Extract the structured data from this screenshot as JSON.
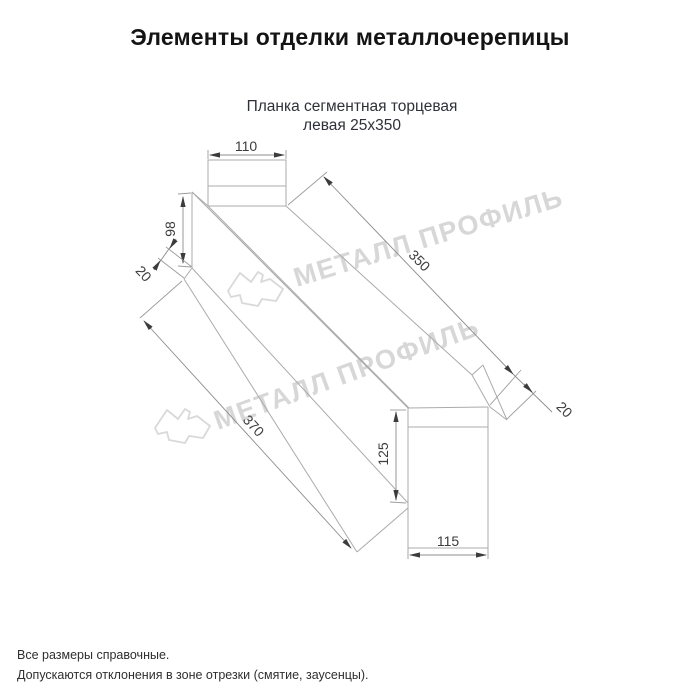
{
  "header": {
    "title": "Элементы отделки металлочерепицы"
  },
  "subtitle": {
    "line1": "Планка сегментная торцевая",
    "line2": "левая 25х350"
  },
  "drawing": {
    "dimensions": {
      "top_width": "110",
      "left_height": "98",
      "left_lip": "20",
      "top_length": "350",
      "right_lip": "20",
      "bottom_length": "370",
      "right_height": "125",
      "right_width": "115"
    },
    "watermark": {
      "text": "МЕТАЛЛ ПРОФИЛЬ",
      "logo": "metal-profil-logo"
    },
    "colors": {
      "line": "#ababab",
      "dimension_text": "#3c3c3c",
      "watermark": "#d7d7d7",
      "title_text": "#141414",
      "subtitle_text": "#2e3139"
    }
  },
  "footer": {
    "line1": "Все размеры справочные.",
    "line2": "Допускаются отклонения в зоне отрезки (смятие, заусенцы)."
  }
}
